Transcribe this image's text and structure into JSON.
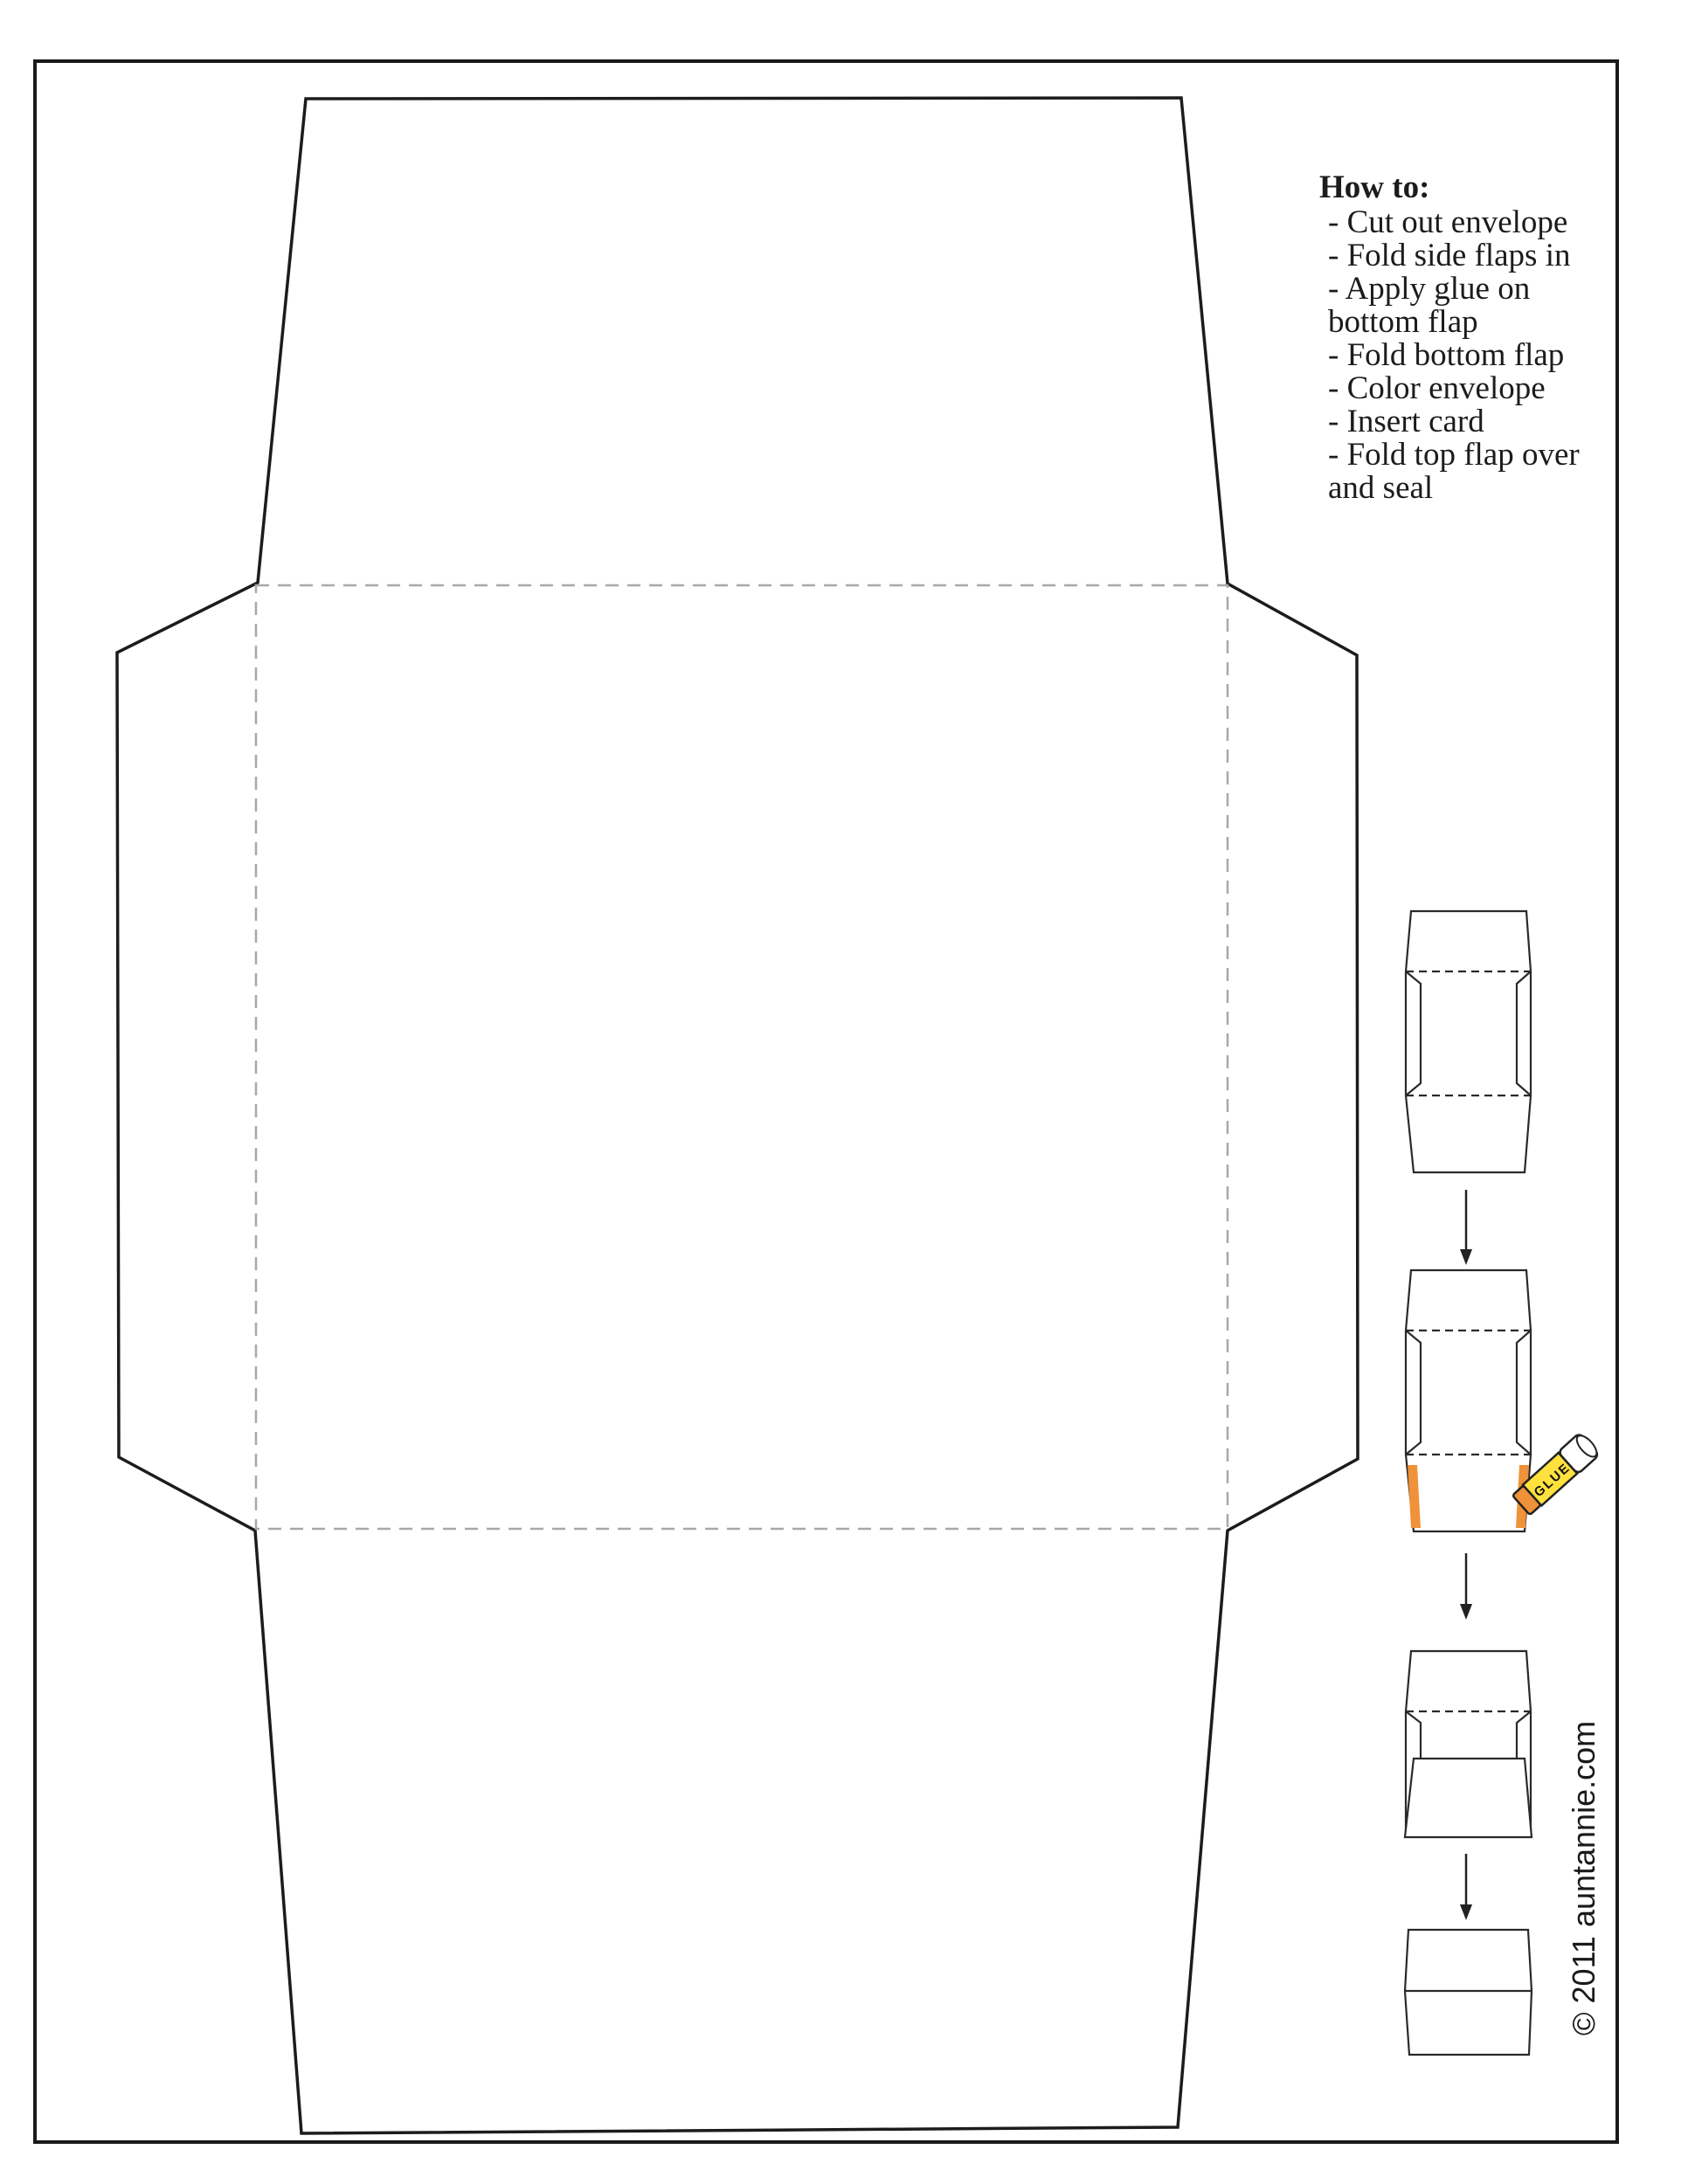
{
  "howto": {
    "title": "How to:",
    "lines": [
      "- Cut out envelope",
      "- Fold side flaps in",
      "- Apply glue on",
      "bottom flap",
      "- Fold bottom flap",
      "- Color envelope",
      "- Insert card",
      "- Fold top flap over",
      "and seal"
    ]
  },
  "copyright": "© 2011 auntannie.com",
  "glue_stick_label": "GLUE",
  "colors": {
    "outline": "#1c1c1c",
    "fold_dash": "#a8a8a8",
    "diagram_line": "#2a2a2a",
    "glue_orange": "#ef9239",
    "glue_yellow": "#ffe13e"
  }
}
